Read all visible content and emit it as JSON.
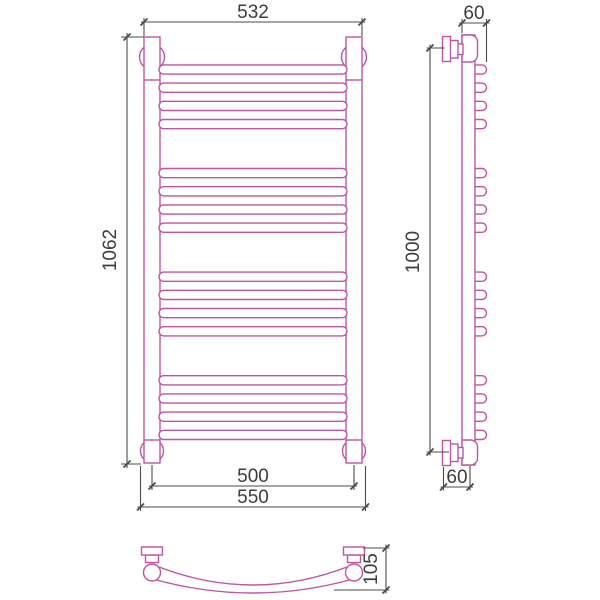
{
  "drawing": {
    "colors": {
      "outline": "#bf55a3",
      "dimension_lines": "#4b4b4b",
      "dimension_text": "#3d3d3d",
      "background": "#ffffff"
    },
    "front_view": {
      "width_top": "532",
      "height": "1062",
      "width_axis": "500",
      "width_overall": "550"
    },
    "side_view": {
      "depth_top": "60",
      "mount_height": "1000",
      "depth_bottom": "60"
    },
    "bottom_view": {
      "bow_depth": "105"
    }
  }
}
